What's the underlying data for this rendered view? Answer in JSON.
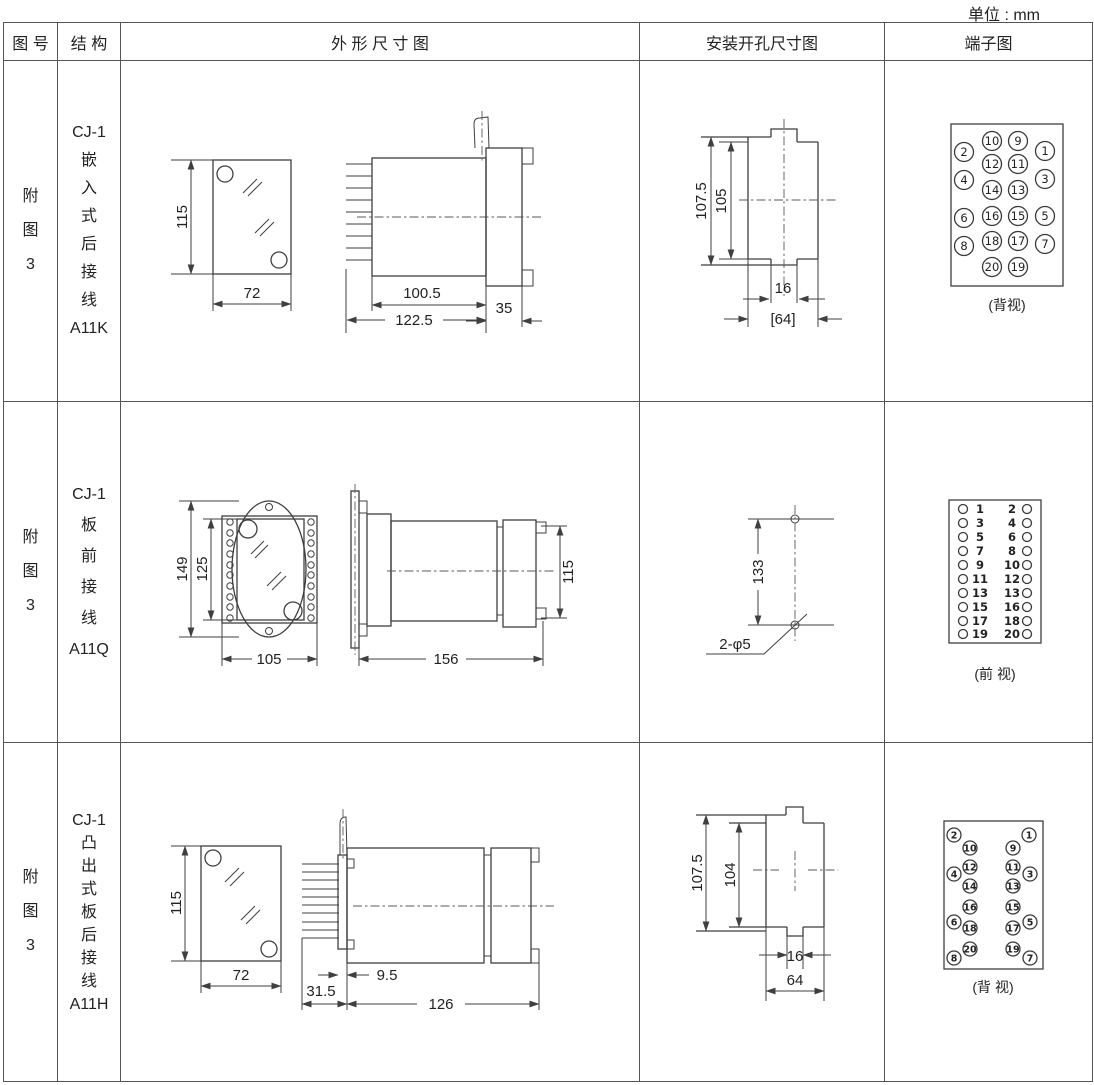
{
  "page": {
    "unit_label": "单位 : mm"
  },
  "header": {
    "figure": "图 号",
    "structure": "结 构",
    "outline": "外 形 尺 寸 图",
    "mounting": "安装开孔尺寸图",
    "terminal": "端子图"
  },
  "rows": [
    {
      "figure": "附\n图\n3",
      "structure": "CJ-1\n嵌\n入\n式\n后\n接\n线\nA11K",
      "outline_dims": {
        "front_height": "115",
        "front_width": "72",
        "side_body_depth": "100.5",
        "side_total_depth": "122.5",
        "side_flange_depth": "35"
      },
      "mounting_dims": {
        "outer_height": "107.5",
        "inner_height": "105",
        "slot_width": "16",
        "opening_width": "[64]"
      },
      "terminal_caption": "(背视)",
      "terminals": [
        {
          "v": "2",
          "x": 79,
          "y": 91,
          "r": 9.5
        },
        {
          "v": "10",
          "x": 107,
          "y": 80,
          "r": 9.5
        },
        {
          "v": "9",
          "x": 133,
          "y": 80,
          "r": 9.5
        },
        {
          "v": "1",
          "x": 160,
          "y": 90,
          "r": 9.5
        },
        {
          "v": "12",
          "x": 107,
          "y": 103,
          "r": 9.5
        },
        {
          "v": "11",
          "x": 133,
          "y": 103,
          "r": 9.5
        },
        {
          "v": "4",
          "x": 79,
          "y": 119,
          "r": 9.5
        },
        {
          "v": "3",
          "x": 160,
          "y": 118,
          "r": 9.5
        },
        {
          "v": "14",
          "x": 107,
          "y": 129,
          "r": 9.5
        },
        {
          "v": "13",
          "x": 133,
          "y": 129,
          "r": 9.5
        },
        {
          "v": "16",
          "x": 107,
          "y": 155,
          "r": 9.5
        },
        {
          "v": "15",
          "x": 133,
          "y": 155,
          "r": 9.5
        },
        {
          "v": "6",
          "x": 79,
          "y": 157,
          "r": 9.5
        },
        {
          "v": "5",
          "x": 160,
          "y": 155,
          "r": 9.5
        },
        {
          "v": "18",
          "x": 107,
          "y": 180,
          "r": 9.5
        },
        {
          "v": "17",
          "x": 133,
          "y": 180,
          "r": 9.5
        },
        {
          "v": "8",
          "x": 79,
          "y": 185,
          "r": 9.5
        },
        {
          "v": "7",
          "x": 160,
          "y": 183,
          "r": 9.5
        },
        {
          "v": "20",
          "x": 107,
          "y": 206,
          "r": 9.5
        },
        {
          "v": "19",
          "x": 133,
          "y": 206,
          "r": 9.5
        }
      ]
    },
    {
      "figure": "附\n图\n3",
      "structure": "CJ-1\n板\n前\n接\n线\nA11Q",
      "outline_dims": {
        "front_outer_height": "149",
        "front_inner_height": "125",
        "front_width": "105",
        "side_length": "156",
        "side_height": "115"
      },
      "mounting_dims": {
        "hole_spacing": "133",
        "holes_label": "2-φ5"
      },
      "terminal_caption": "(前 视)",
      "terminals": [
        {
          "x": 78,
          "y": 107,
          "r": 4.5
        },
        {
          "v": "1",
          "x": 95,
          "y": 107
        },
        {
          "v": "2",
          "x": 127,
          "y": 107
        },
        {
          "x": 142,
          "y": 107,
          "r": 4.5
        },
        {
          "x": 78,
          "y": 121,
          "r": 4.5
        },
        {
          "v": "3",
          "x": 95,
          "y": 121
        },
        {
          "v": "4",
          "x": 127,
          "y": 121
        },
        {
          "x": 142,
          "y": 121,
          "r": 4.5
        },
        {
          "x": 78,
          "y": 135,
          "r": 4.5
        },
        {
          "v": "5",
          "x": 95,
          "y": 135
        },
        {
          "v": "6",
          "x": 127,
          "y": 135
        },
        {
          "x": 142,
          "y": 135,
          "r": 4.5
        },
        {
          "x": 78,
          "y": 149,
          "r": 4.5
        },
        {
          "v": "7",
          "x": 95,
          "y": 149
        },
        {
          "v": "8",
          "x": 127,
          "y": 149
        },
        {
          "x": 142,
          "y": 149,
          "r": 4.5
        },
        {
          "x": 78,
          "y": 163,
          "r": 4.5
        },
        {
          "v": "9",
          "x": 95,
          "y": 163
        },
        {
          "v": "10",
          "x": 127,
          "y": 163
        },
        {
          "x": 142,
          "y": 163,
          "r": 4.5
        },
        {
          "x": 78,
          "y": 177,
          "r": 4.5
        },
        {
          "v": "11",
          "x": 95,
          "y": 177
        },
        {
          "v": "12",
          "x": 127,
          "y": 177
        },
        {
          "x": 142,
          "y": 177,
          "r": 4.5
        },
        {
          "x": 78,
          "y": 191,
          "r": 4.5
        },
        {
          "v": "13",
          "x": 95,
          "y": 191
        },
        {
          "v": "13",
          "x": 127,
          "y": 191
        },
        {
          "x": 142,
          "y": 191,
          "r": 4.5
        },
        {
          "x": 78,
          "y": 205,
          "r": 4.5
        },
        {
          "v": "15",
          "x": 95,
          "y": 205
        },
        {
          "v": "16",
          "x": 127,
          "y": 205
        },
        {
          "x": 142,
          "y": 205,
          "r": 4.5
        },
        {
          "x": 78,
          "y": 219,
          "r": 4.5
        },
        {
          "v": "17",
          "x": 95,
          "y": 219
        },
        {
          "v": "18",
          "x": 127,
          "y": 219
        },
        {
          "x": 142,
          "y": 219,
          "r": 4.5
        },
        {
          "x": 78,
          "y": 232,
          "r": 4.5
        },
        {
          "v": "19",
          "x": 95,
          "y": 232
        },
        {
          "v": "20",
          "x": 127,
          "y": 232
        },
        {
          "x": 142,
          "y": 232,
          "r": 4.5
        }
      ]
    },
    {
      "figure": "附\n图\n3",
      "structure": "CJ-1\n凸\n出\n式\n板\n后\n接\n线\nA11H",
      "outline_dims": {
        "front_height": "115",
        "front_width": "72",
        "plate_thickness": "9.5",
        "pin_length": "31.5",
        "side_length": "126"
      },
      "mounting_dims": {
        "outer_height": "107.5",
        "inner_height": "104",
        "slot_width": "16",
        "opening_width": "64"
      },
      "terminal_caption": "(背 视)",
      "terminals": [
        {
          "v": "2",
          "x": 69,
          "y": 92,
          "r": 7
        },
        {
          "v": "1",
          "x": 144,
          "y": 92,
          "r": 7
        },
        {
          "v": "10",
          "x": 85,
          "y": 105,
          "r": 7
        },
        {
          "v": "9",
          "x": 128,
          "y": 105,
          "r": 7
        },
        {
          "v": "12",
          "x": 85,
          "y": 124,
          "r": 7
        },
        {
          "v": "11",
          "x": 128,
          "y": 124,
          "r": 7
        },
        {
          "v": "4",
          "x": 69,
          "y": 131,
          "r": 7
        },
        {
          "v": "3",
          "x": 145,
          "y": 131,
          "r": 7
        },
        {
          "v": "14",
          "x": 85,
          "y": 143,
          "r": 7
        },
        {
          "v": "13",
          "x": 128,
          "y": 143,
          "r": 7
        },
        {
          "v": "16",
          "x": 85,
          "y": 164,
          "r": 7
        },
        {
          "v": "15",
          "x": 128,
          "y": 164,
          "r": 7
        },
        {
          "v": "6",
          "x": 69,
          "y": 179,
          "r": 7
        },
        {
          "v": "5",
          "x": 145,
          "y": 179,
          "r": 7
        },
        {
          "v": "18",
          "x": 85,
          "y": 185,
          "r": 7
        },
        {
          "v": "17",
          "x": 128,
          "y": 185,
          "r": 7
        },
        {
          "v": "20",
          "x": 85,
          "y": 206,
          "r": 7
        },
        {
          "v": "19",
          "x": 128,
          "y": 206,
          "r": 7
        },
        {
          "v": "8",
          "x": 69,
          "y": 215,
          "r": 7
        },
        {
          "v": "7",
          "x": 145,
          "y": 215,
          "r": 7
        }
      ]
    }
  ]
}
